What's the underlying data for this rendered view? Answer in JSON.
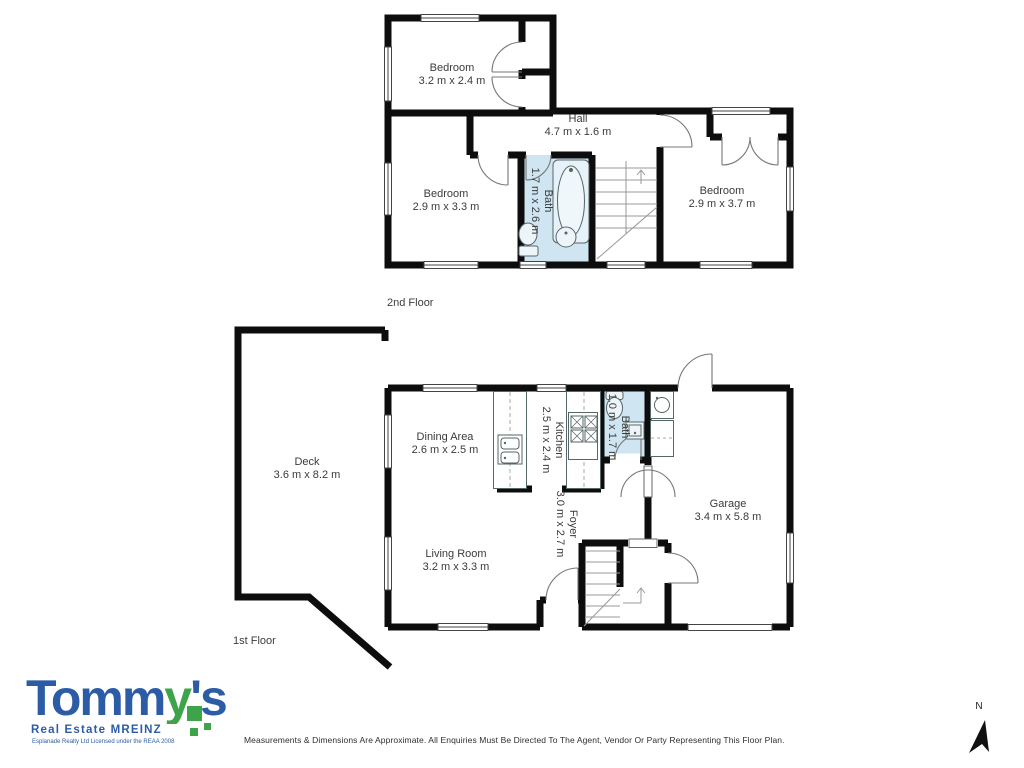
{
  "floors": [
    {
      "label": "2nd Floor",
      "rooms": [
        {
          "name": "Bedroom",
          "dims": "3.2 m x 2.4 m"
        },
        {
          "name": "Hall",
          "dims": "4.7 m x 1.6 m"
        },
        {
          "name": "Bedroom",
          "dims": "2.9 m x 3.3 m"
        },
        {
          "name": "Bath",
          "dims": "1.7 m x 2.6 m"
        },
        {
          "name": "Bedroom",
          "dims": "2.9 m x 3.7 m"
        }
      ]
    },
    {
      "label": "1st Floor",
      "rooms": [
        {
          "name": "Deck",
          "dims": "3.6 m x 8.2 m"
        },
        {
          "name": "Dining Area",
          "dims": "2.6 m x 2.5 m"
        },
        {
          "name": "Kitchen",
          "dims": "2.5 m x 2.4 m"
        },
        {
          "name": "Bath",
          "dims": "1.0 m x 1.7 m"
        },
        {
          "name": "Garage",
          "dims": "3.4 m x 5.8 m"
        },
        {
          "name": "Foyer",
          "dims": "3.0 m x 2.7 m"
        },
        {
          "name": "Living Room",
          "dims": "3.2 m x 3.3 m"
        }
      ]
    }
  ],
  "logo": {
    "word_part1": "Tomm",
    "word_part2": "y",
    "word_part3": "'s",
    "tagline": "Real Estate MREINZ",
    "license": "Esplanade Realty Ltd Licensed under the REAA 2008",
    "brand_blue": "#2d5ca6",
    "brand_green": "#3ea449"
  },
  "footer": {
    "disclaimer": "Measurements & Dimensions Are Approximate. All Enquiries Must Be Directed To The Agent, Vendor Or Party Representing This Floor Plan."
  },
  "compass": {
    "label": "N"
  },
  "colors": {
    "wall": "#0d0d0d",
    "bath_fill": "#cfe5f1",
    "label_text": "#3b3b3b"
  }
}
